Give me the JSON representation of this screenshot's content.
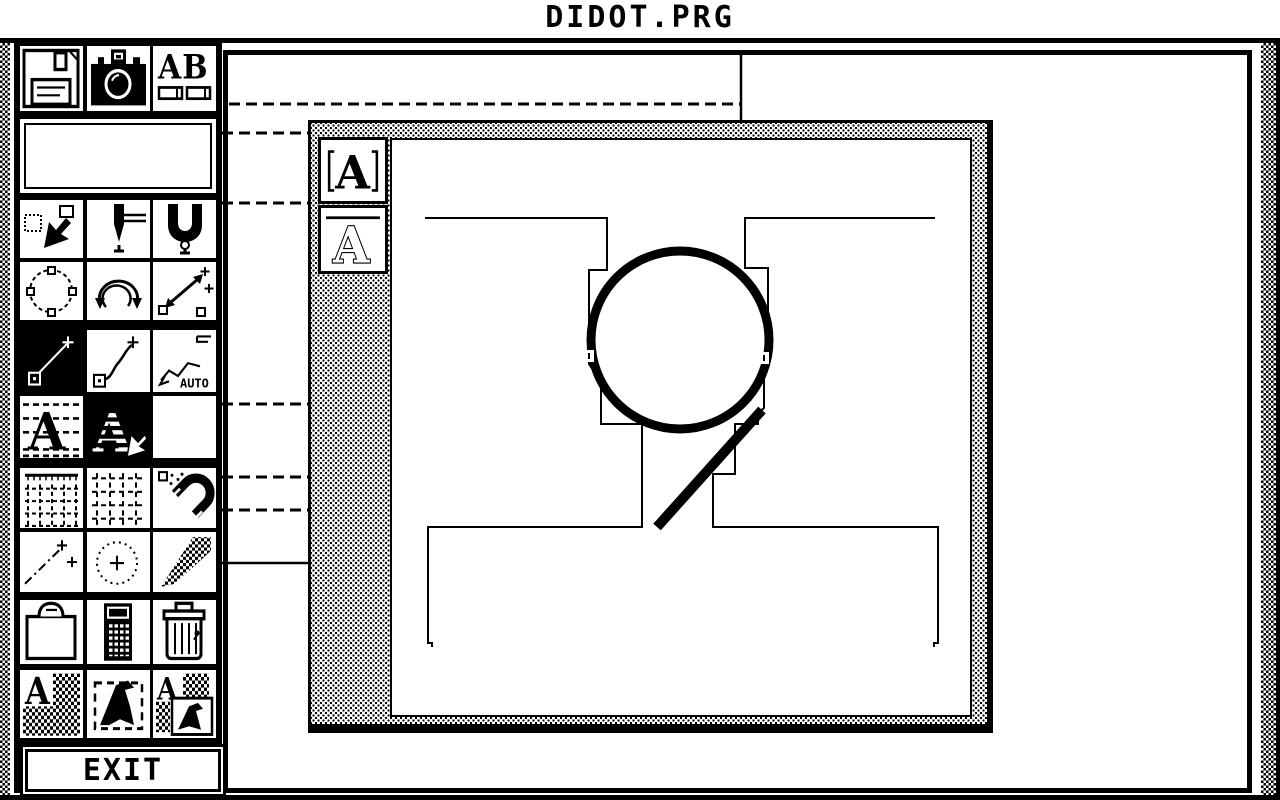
{
  "window_title": "DIDOT.PRG",
  "colors": {
    "foreground": "#000000",
    "background": "#ffffff"
  },
  "icon_text": {
    "a": "A",
    "ab": "AB",
    "auto": "AUTO"
  },
  "toolbox": {
    "exit_label": "EXIT",
    "selected_tool": "line",
    "groups": [
      {
        "name": "file",
        "rows": [
          [
            "floppy-disk",
            "camera",
            "font-ab"
          ]
        ]
      },
      {
        "name": "preview",
        "preview": true
      },
      {
        "name": "selection",
        "rows": [
          [
            "select-arrow",
            "knife",
            "clamp"
          ],
          [
            "circle-points",
            "rotate",
            "move-points"
          ]
        ]
      },
      {
        "name": "drawing",
        "rows": [
          [
            "line",
            "curve",
            "auto-trace"
          ],
          [
            "letter-guides",
            "letter-hatched",
            "blank"
          ]
        ]
      },
      {
        "name": "grids",
        "rows": [
          [
            "grid-ruler",
            "grid-snap",
            "magnet"
          ],
          [
            "measure",
            "circle-center",
            "pixel-wedge"
          ]
        ]
      },
      {
        "name": "utilities",
        "rows": [
          [
            "clipboard",
            "calculator",
            "trash"
          ]
        ]
      },
      {
        "name": "letter-ops",
        "rows": [
          [
            "letter-checker",
            "glyph-select",
            "letter-window"
          ]
        ]
      }
    ]
  },
  "glyph_window": {
    "buttons": [
      {
        "icon": "a-bracketed"
      },
      {
        "icon": "a-outlined"
      }
    ],
    "outline_paths": [
      "M425,218 L607,218 L607,270 L589,270 L589,364 L593,370 L601,378 L601,424 L642,424 L642,527 L428,527 L428,643 L432,643 L432,647",
      "M935,218 L745,218 L745,268 L768,268 L768,358 L764,362 L764,408 L758,413 L758,424 L735,424 L735,474 L713,474 L713,527 L938,527 L938,643 L934,643 L934,647"
    ],
    "drawn_circle": {
      "cx": 680,
      "cy": 340,
      "r": 89,
      "stroke_width": 9
    },
    "drawn_tail": {
      "x1": 762,
      "y1": 410,
      "x2": 657,
      "y2": 527,
      "stroke_width": 10
    },
    "handles": [
      {
        "x": 582,
        "y": 350,
        "size": 12,
        "tick_x": 589
      },
      {
        "x": 757,
        "y": 352,
        "size": 12,
        "tick_x": 764
      }
    ]
  },
  "leader_lines": [
    {
      "x1": 229,
      "y1": 104,
      "x2": 740,
      "y2": 104,
      "dashed": true
    },
    {
      "x1": 741,
      "y1": 55,
      "x2": 741,
      "y2": 122,
      "dashed": false
    },
    {
      "x1": 222,
      "y1": 133,
      "x2": 308,
      "y2": 133,
      "dashed": true
    },
    {
      "x1": 222,
      "y1": 203,
      "x2": 308,
      "y2": 203,
      "dashed": true
    },
    {
      "x1": 222,
      "y1": 404,
      "x2": 308,
      "y2": 404,
      "dashed": true
    },
    {
      "x1": 222,
      "y1": 477,
      "x2": 308,
      "y2": 477,
      "dashed": true
    },
    {
      "x1": 222,
      "y1": 510,
      "x2": 308,
      "y2": 510,
      "dashed": true
    },
    {
      "x1": 222,
      "y1": 563,
      "x2": 308,
      "y2": 563,
      "dashed": false
    }
  ]
}
